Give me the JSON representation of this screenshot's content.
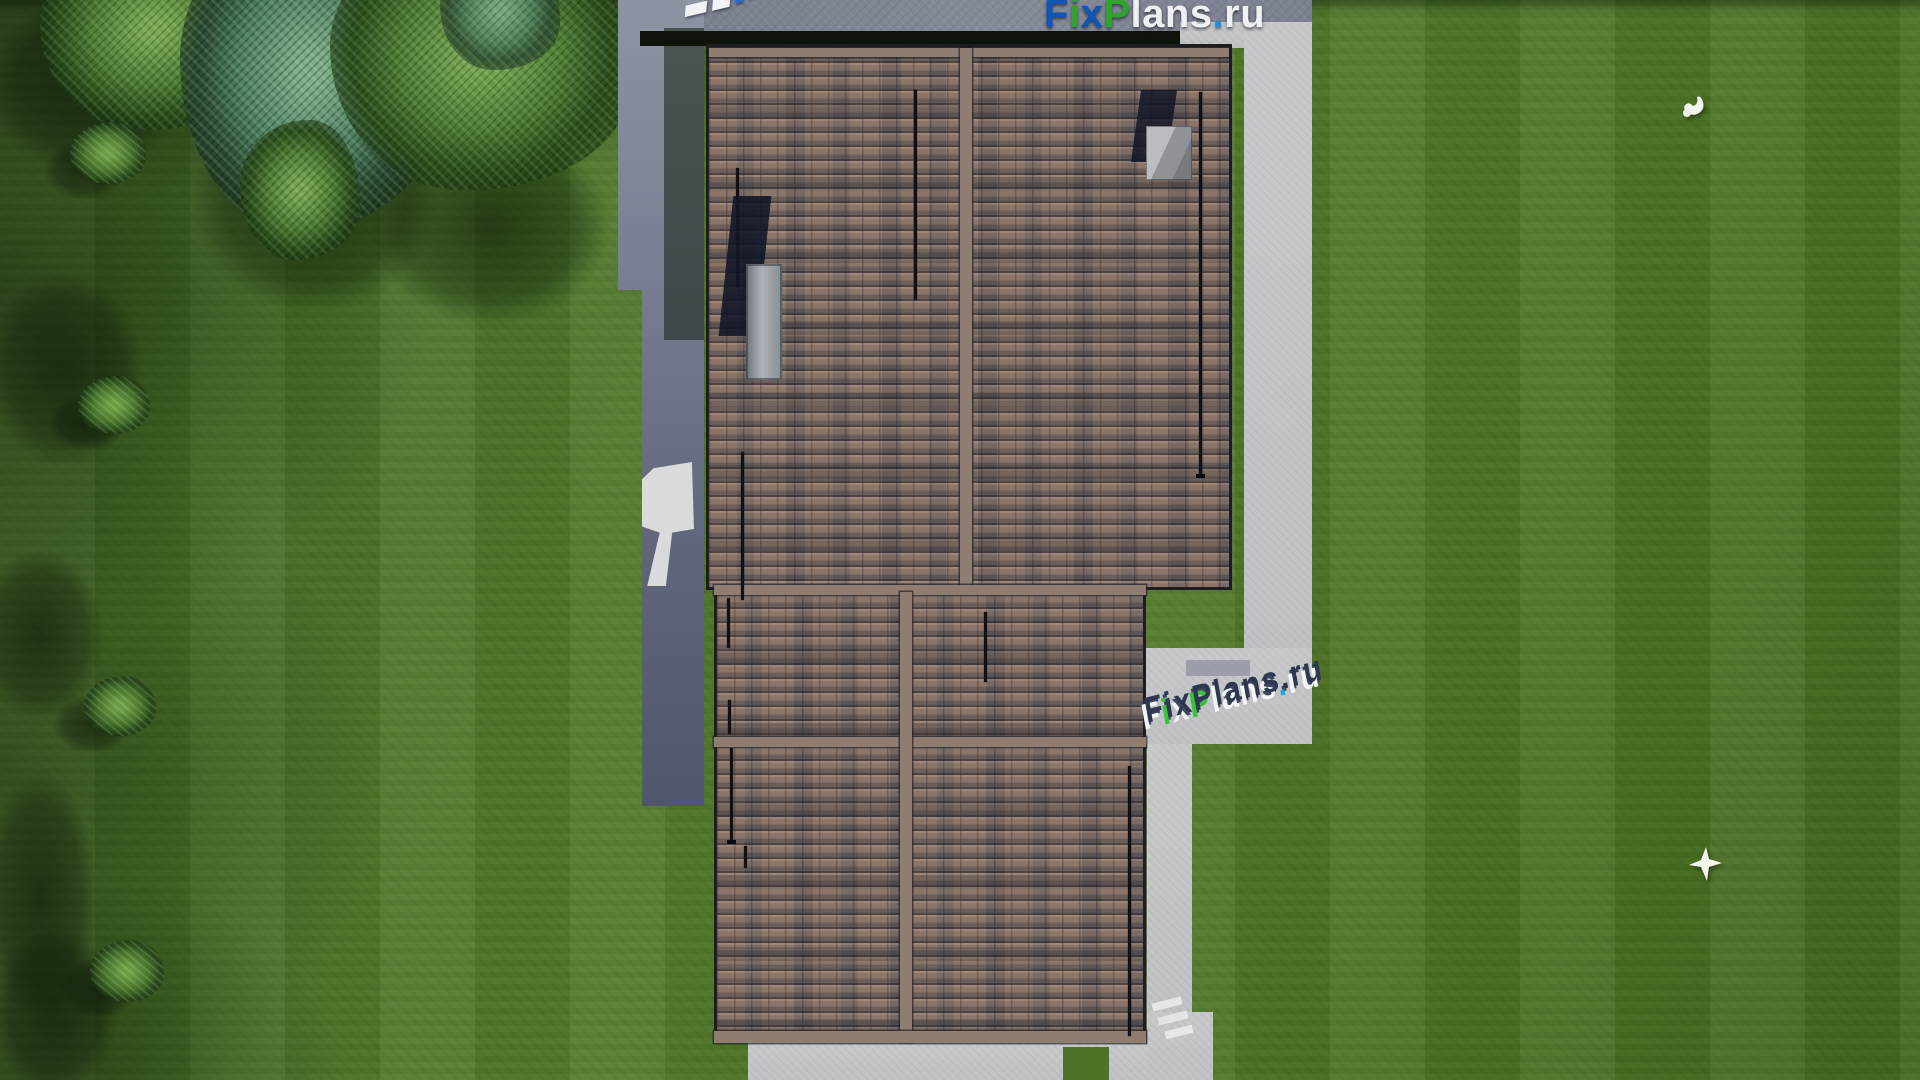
{
  "brand": {
    "name": "FixPlans.ru"
  },
  "watermarks": {
    "top_right": {
      "parts": [
        {
          "ch": "F",
          "color": "#1254b4"
        },
        {
          "ch": "i",
          "color": "#2fa42d"
        },
        {
          "ch": "x",
          "color": "#1254b4"
        },
        {
          "ch": "P",
          "color": "#2fa42d"
        },
        {
          "ch": "lans",
          "color": "#eef0f3"
        },
        {
          "ch": ".",
          "color": "#1f8ede"
        },
        {
          "ch": "ru",
          "color": "#eef0f3"
        }
      ]
    },
    "ground": {
      "parts": [
        {
          "ch": "F",
          "face": "#f2f4f6"
        },
        {
          "ch": "i",
          "face": "#38c13a"
        },
        {
          "ch": "x",
          "face": "#f2f4f6"
        },
        {
          "ch": "P",
          "face": "#38c13a"
        },
        {
          "ch": "l",
          "face": "#f2f4f6"
        },
        {
          "ch": "a",
          "face": "#f2f4f6"
        },
        {
          "ch": "n",
          "face": "#f2f4f6"
        },
        {
          "ch": "s",
          "face": "#f2f4f6"
        },
        {
          "ch": ".",
          "face": "#1ba4ec"
        },
        {
          "ch": "r",
          "face": "#f2f4f6"
        },
        {
          "ch": "u",
          "face": "#f2f4f6"
        }
      ]
    }
  },
  "colors": {
    "grass": "#4d7329",
    "grass_shadow": "#1d3511",
    "concrete_slab": "#7d8292",
    "concrete_path": "#c3c5c7",
    "wall_shadow": "#5e6579",
    "roof_tile_light": "#9b887b",
    "roof_tile_dark": "#47474f",
    "roof_fascia": "#8e7d70",
    "roof_border": "#1d1d22",
    "chimney_gray": "#9ca0a4",
    "chimney_shadow": "#1b2130",
    "logo_blue": "#1254b4",
    "logo_green": "#2fa42d",
    "logo_white": "#eef0f3",
    "logo_dot_blue": "#1f8ede",
    "extrusion_navy": "#2e3650",
    "bird_white": "#f6f6f1"
  },
  "scene": {
    "bird_count": 2
  }
}
